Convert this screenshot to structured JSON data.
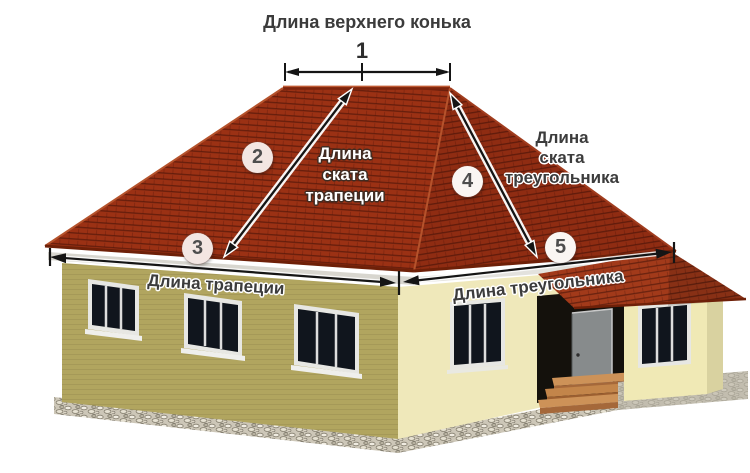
{
  "labels": {
    "ridge_title": "Длина верхнего конька",
    "trapezoid_slope": [
      "Длина",
      "ската",
      "трапеции"
    ],
    "triangle_slope": [
      "Длина",
      "ската",
      "треугольника"
    ],
    "trapezoid_base": "Длина трапеции",
    "triangle_base": "Длина треугольника"
  },
  "numbers": [
    "1",
    "2",
    "3",
    "4",
    "5"
  ],
  "colors": {
    "roof_front": "#9b3114",
    "roof_side": "#8f2c12",
    "roof_porch": "#a23a1a",
    "wall_front": "#b1a55f",
    "wall_side": "#efe8ba",
    "wall_porch": "#f0e9b5",
    "wall_porch_side": "#d9d2a0",
    "foundation_stone": "#cdc7b8",
    "porch_foundation": "#bcb8aa",
    "steps_wood": "#cd9258",
    "steps_wood_dark": "#a5683a",
    "door": "#878b8c",
    "doorway_shadow": "#14110c",
    "window_glass": "#10151d",
    "window_frame": "#e7e7e3",
    "arrow": "#151515",
    "marker_circle": "#f3e6e2",
    "label_light": "#ffffff",
    "label_dark": "#3c3c3c"
  }
}
